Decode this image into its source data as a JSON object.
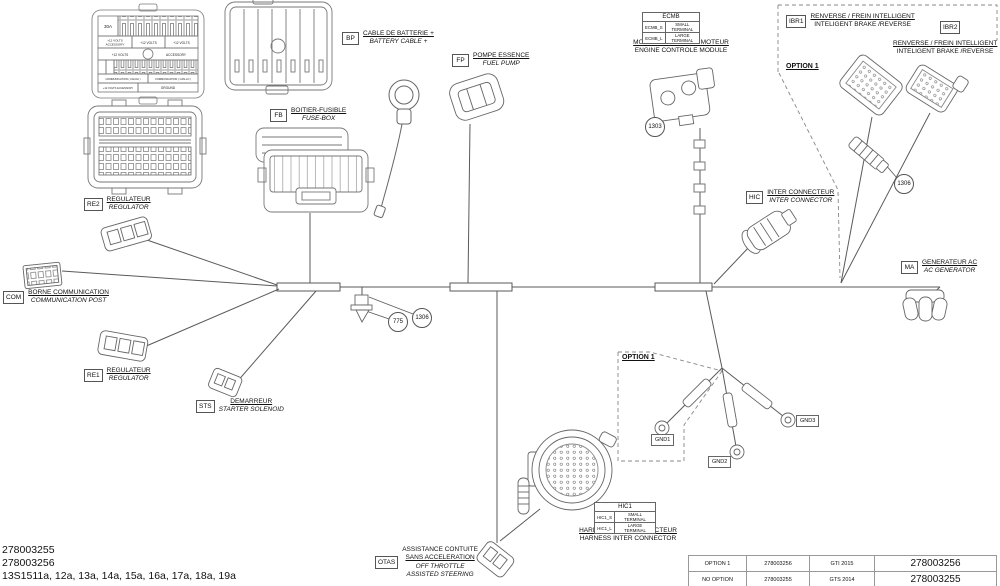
{
  "footer": {
    "part_a": "278003255",
    "part_b": "278003256",
    "sheets": "13S1511a, 12a, 13a, 14a, 15a, 16a, 17a, 18a, 19a"
  },
  "ref_table": {
    "rows": [
      [
        "OPTION 1",
        "278003256",
        "GTI 2015",
        "278003256"
      ],
      [
        "NO OPTION",
        "278003255",
        "GTS 2014",
        "278003255"
      ]
    ]
  },
  "options": {
    "top_right": "OPTION 1",
    "middle": "OPTION 1"
  },
  "callouts": {
    "c1303": "1303",
    "c775": "775",
    "c1306_a": "1306",
    "c1306_b": "1306"
  },
  "grounds": {
    "gnd1": "GND1",
    "gnd2": "GND2",
    "gnd3": "GND3"
  },
  "components": {
    "com": {
      "code": "COM",
      "fr": "BORNE COMMUNICATION",
      "en": "COMMUNICATION POST"
    },
    "re2": {
      "code": "RE2",
      "fr": "REGULATEUR",
      "en": "REGULATOR"
    },
    "re1": {
      "code": "RE1",
      "fr": "REGULATEUR",
      "en": "REGULATOR"
    },
    "bp": {
      "code": "BP",
      "fr": "CABLE DE BATTERIE +",
      "en": "BATTERY CABLE +"
    },
    "fb": {
      "code": "FB",
      "fr": "BOITIER-FUSIBLE",
      "en": "FUSE-BOX"
    },
    "fp": {
      "code": "FP",
      "fr": "POMPE ESSENCE",
      "en": "FUEL PUMP"
    },
    "ecmb": {
      "fr": "MODULE CONTROLE MOTEUR",
      "en": "ENGINE CONTROLE MODULE"
    },
    "ibr1": {
      "code": "IBR1",
      "fr": "RENVERSE / FREIN INTELLIGENT",
      "en": "INTELIGENT BRAKE /REVERSE"
    },
    "ibr2": {
      "code": "IBR2",
      "fr": "RENVERSE / FREIN INTELLIGENT",
      "en": "INTELIGENT BRAKE /REVERSE"
    },
    "hic": {
      "code": "HIC",
      "fr": "INTER CONNECTEUR",
      "en": "INTER CONNECTOR"
    },
    "ma": {
      "code": "MA",
      "fr": "GENERATEUR AC",
      "en": "AC GENERATOR"
    },
    "sts": {
      "code": "STS",
      "fr": "DEMARREUR",
      "en": "STARTER SOLENOID"
    },
    "otas": {
      "code": "OTAS",
      "fr1": "ASSISTANCE CONTUITE",
      "fr2": "SANS ACCELERATION",
      "en1": "OFF THROTTLE",
      "en2": "ASSISTED STEERING"
    },
    "hic1": {
      "fr": "HARNAIS INTER CONNECTEUR",
      "en": "HARNESS INTER CONNECTOR"
    }
  },
  "terminal_tables": {
    "ecmb": {
      "header": "ECMB",
      "rows": [
        {
          "k": "ECMB_S",
          "v": "SMALL TERMINAL"
        },
        {
          "k": "ECMB_L",
          "v": "LARGE TERMINAL"
        }
      ]
    },
    "hic1": {
      "header": "HIC1",
      "rows": [
        {
          "k": "HIC1_S",
          "v": "SMALL TERMINAL"
        },
        {
          "k": "HIC1_L",
          "v": "LARGE TERMINAL"
        }
      ]
    }
  },
  "fusebox": {
    "f30": "30A",
    "top_acc_l1": "+12 VOLTS",
    "top_acc_l2": "ACCESSORY",
    "v12a": "+12 VOLTS",
    "v12b": "+12 VOLTS",
    "mid_left": "+12 VOLTS",
    "mid_right": "ACCESSORY",
    "comm_hi": "COMMUNICATION ( CAN-HI )",
    "comm_lo": "COMMUNICATION ( CAN-LO )",
    "bottom_acc": "+12 VOLTS ACCESSORY",
    "ground": "GROUND"
  }
}
